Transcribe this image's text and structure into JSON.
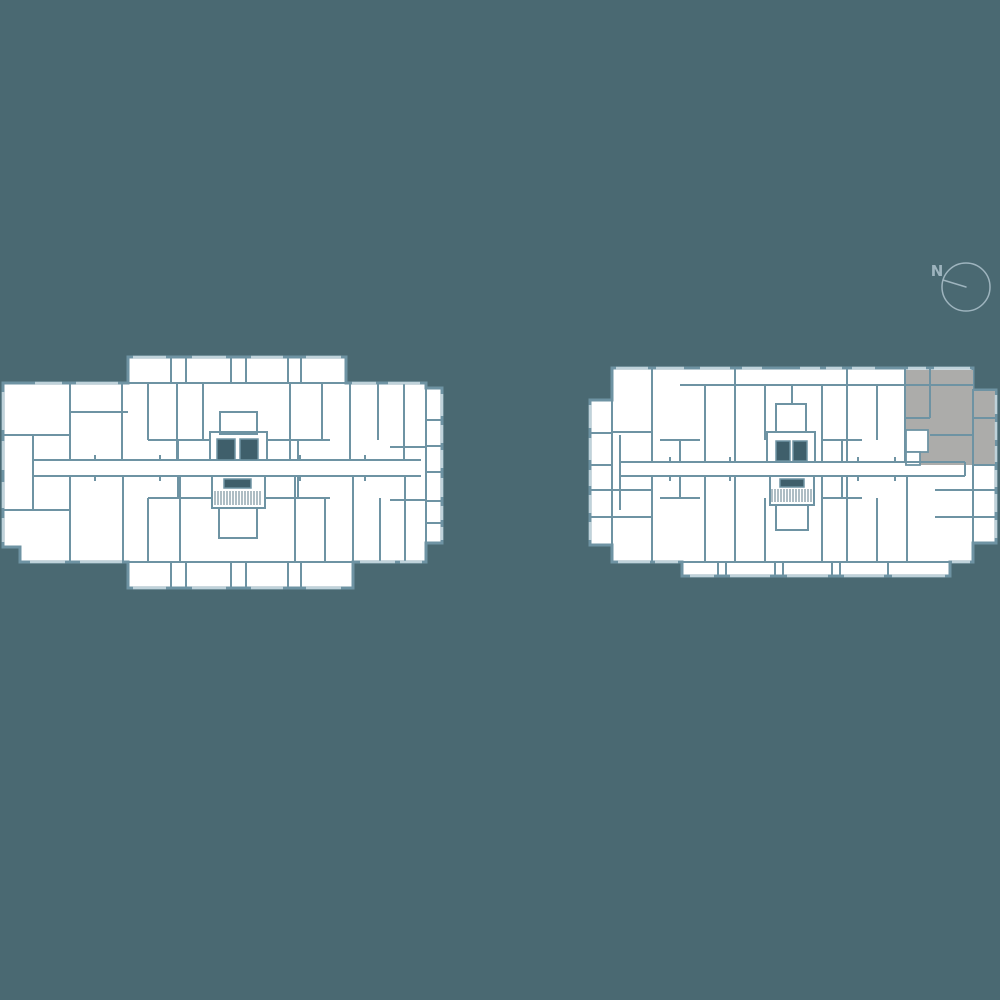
{
  "compass": {
    "label": "N"
  },
  "colors": {
    "background": "#4a6972",
    "wall": "#6e93a3",
    "wall_light": "#bfd2da",
    "floor_fill": "#ffffff",
    "highlight_unit_fill": "#acacaa",
    "core_fill": "#3f5f6b",
    "stair_hatch": "#5e7b89",
    "compass": "#9eb4be"
  }
}
